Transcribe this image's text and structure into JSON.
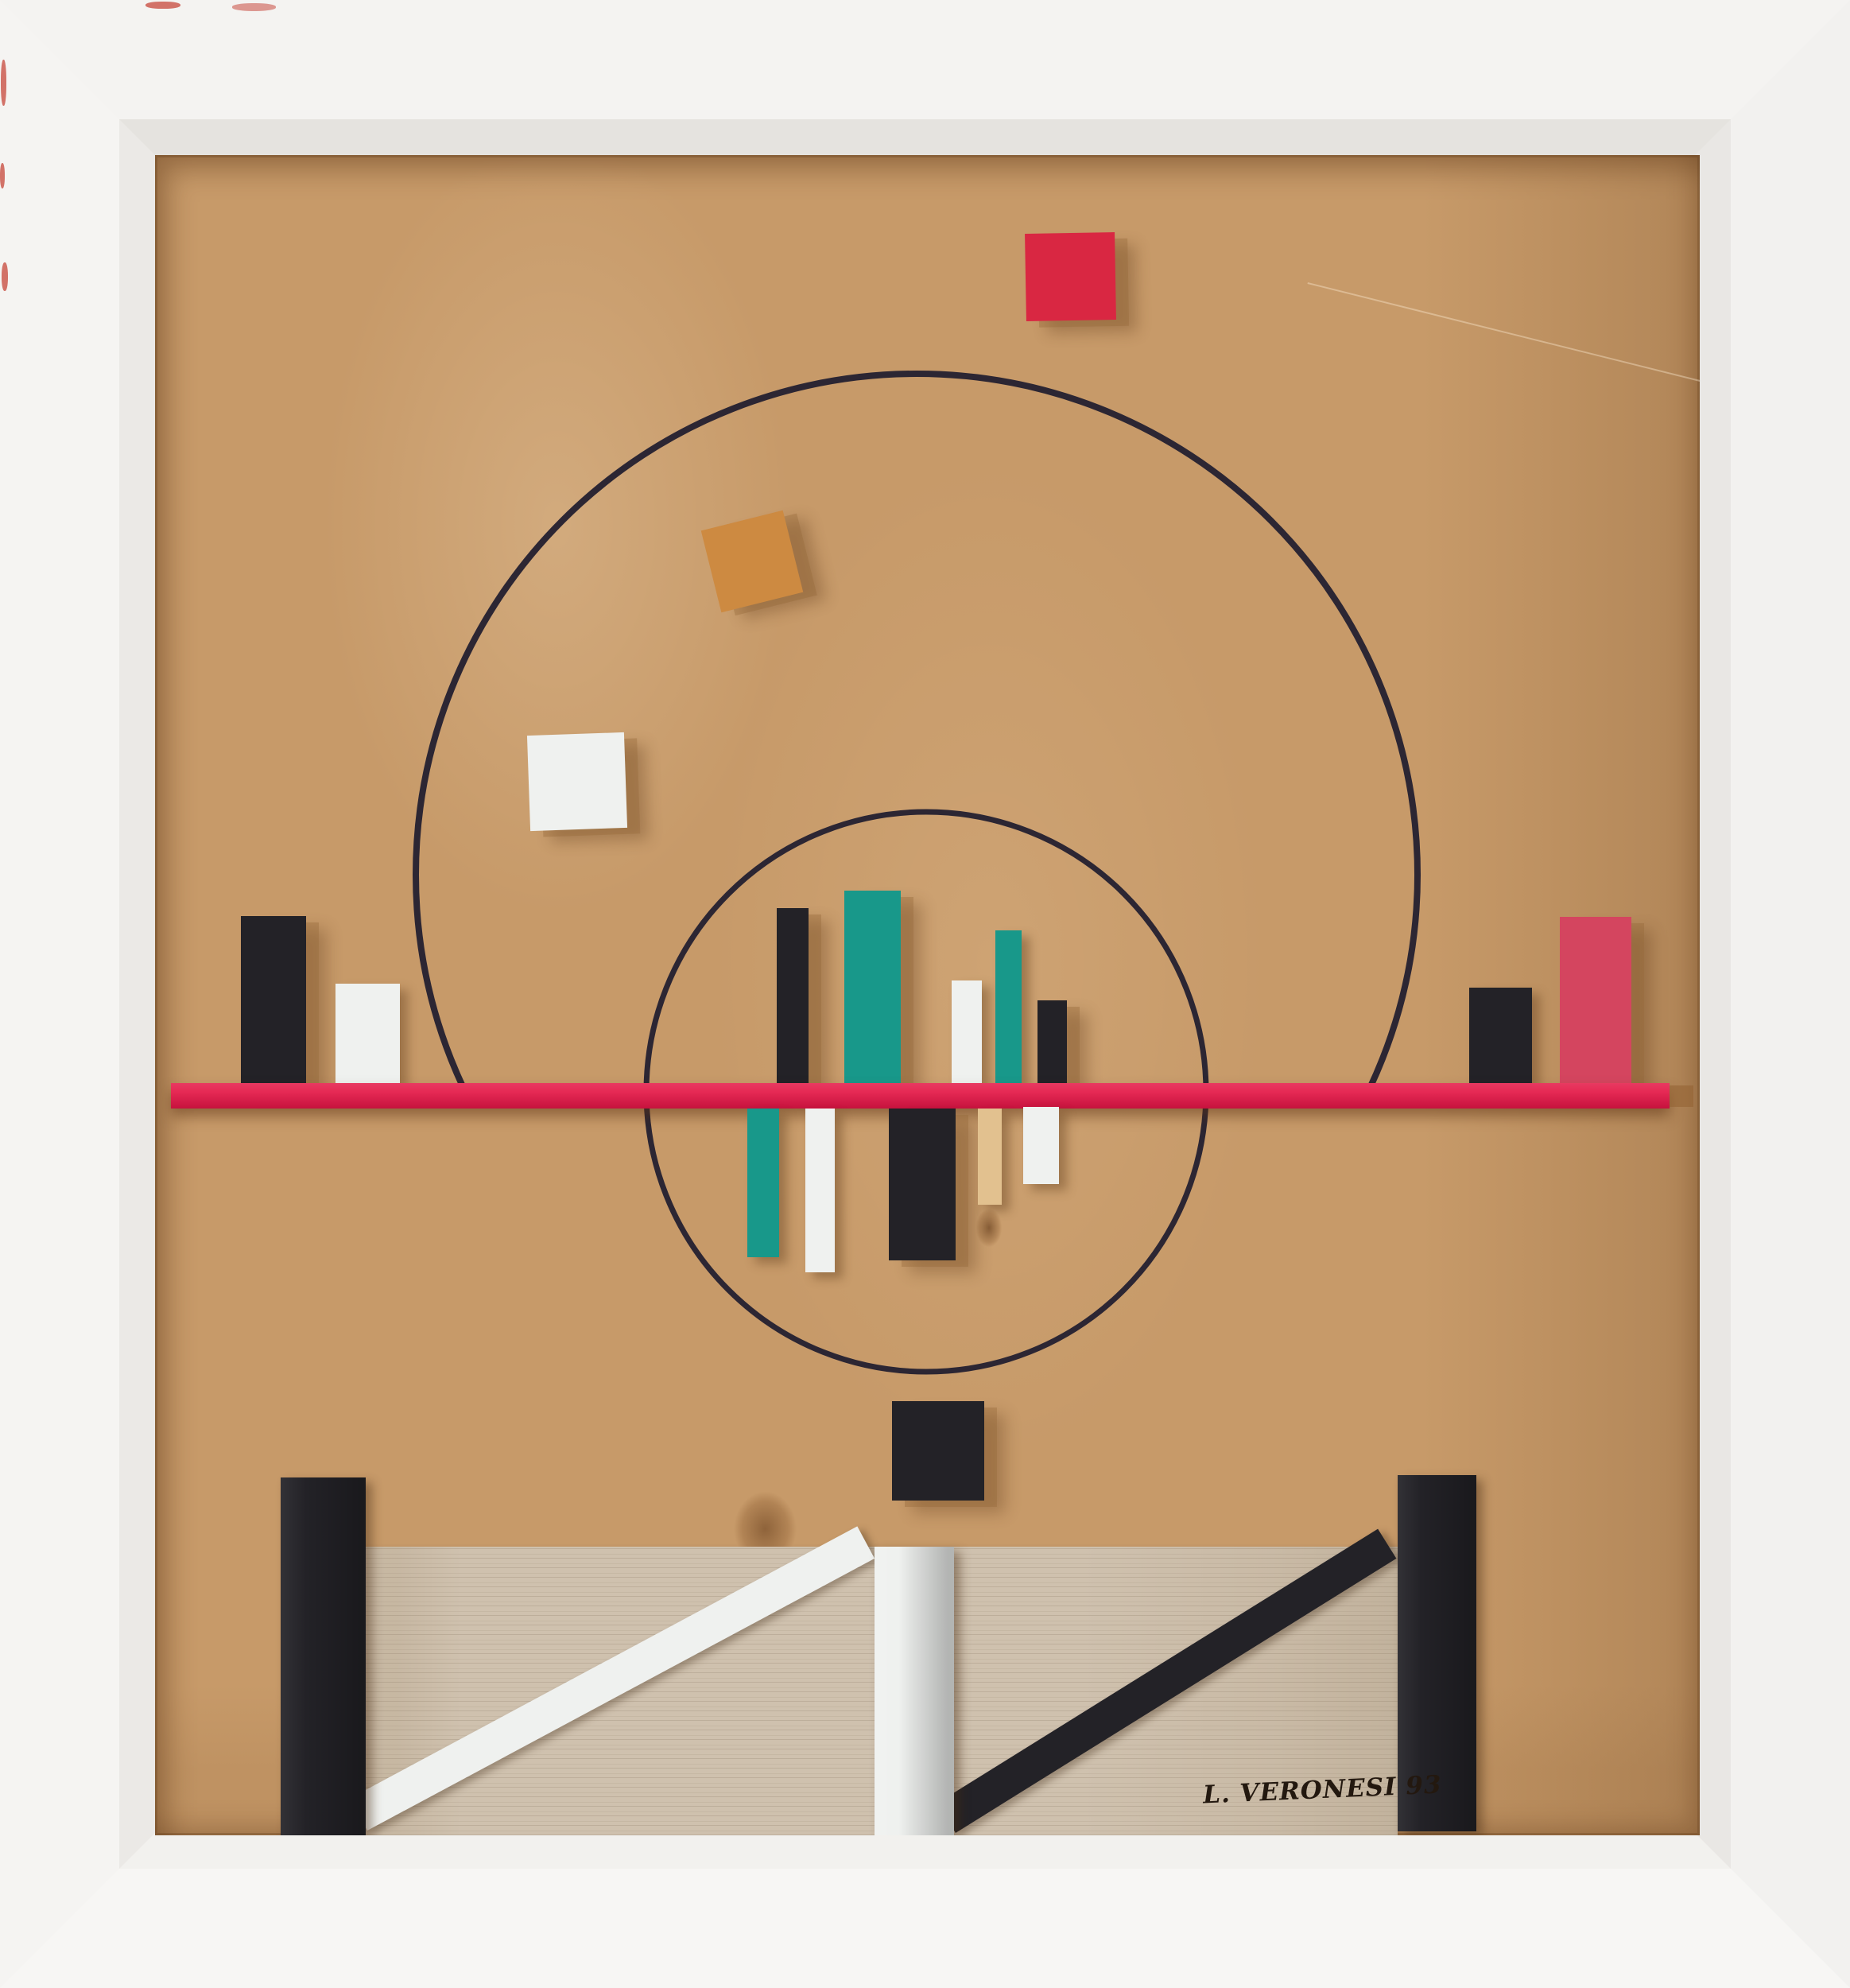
{
  "artwork": {
    "description": "Framed abstract constructivist wood relief: painted wood blocks and laths on a pine panel with two inked circles, white frame",
    "signature": "L. VERONESI 93",
    "palette": {
      "frame_white": "#f4f3f1",
      "frame_bevel": "#e8e6e2",
      "pine_wood": "#c79a69",
      "oak_wood": "#cfc1ae",
      "shelf_red": "#e01848",
      "square_red": "#d92742",
      "crimson_block": "#d4455f",
      "teal": "#18988a",
      "black": "#232227",
      "white_paint": "#eff1ef",
      "orange": "#cd8a41",
      "tan": "#e2c18f",
      "ink": "#2c2633",
      "chip_red": "#cb5a50"
    },
    "counts": {
      "circles": "2",
      "blocks_above_shelf": "9",
      "blocks_below_shelf": "5",
      "loose_squares": "4"
    }
  }
}
